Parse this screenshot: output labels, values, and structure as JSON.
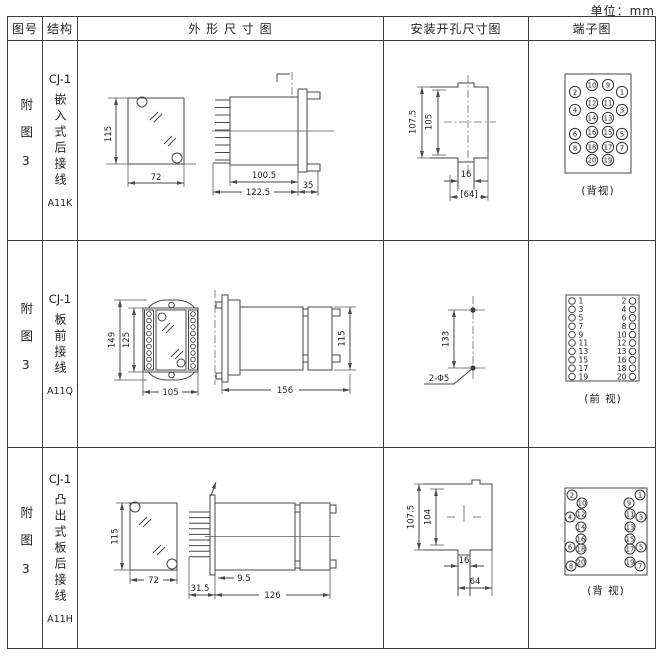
{
  "unit_label": "单位：mm",
  "header": {
    "fig_no": "图号",
    "structure": "结构",
    "outline": "外 形 尺 寸 图",
    "install": "安装开孔尺寸图",
    "terminal": "端子图"
  },
  "rows": [
    {
      "fig_no": "附图3",
      "model": "CJ-1",
      "mount_type": "嵌入式后接线",
      "code": "A11K",
      "outline": {
        "front_height": "115",
        "front_width": "72",
        "body_depth": "100.5",
        "total_depth": "122.5",
        "flange_depth": "35"
      },
      "install": {
        "height_outer": "107.5",
        "height_inner": "105",
        "notch_width": "16",
        "cutout_width": "[64]"
      },
      "terminal": {
        "caption": "(背视)",
        "inner_left": [
          "10",
          "12",
          "14",
          "16",
          "18",
          "20"
        ],
        "inner_right": [
          "9",
          "11",
          "13",
          "15",
          "17",
          "19"
        ],
        "outer_left": [
          "2",
          "4",
          "6",
          "8"
        ],
        "outer_right": [
          "1",
          "3",
          "5",
          "7"
        ]
      }
    },
    {
      "fig_no": "附图3",
      "model": "CJ-1",
      "mount_type": "板前接线",
      "code": "A11Q",
      "outline": {
        "front_height_outer": "149",
        "front_height_inner": "125",
        "front_width": "105",
        "total_depth": "156",
        "body_height": "115"
      },
      "install": {
        "hole_spacing": "133",
        "hole_note": "2-Φ5"
      },
      "terminal": {
        "caption": "(前 视)",
        "left": [
          "1",
          "3",
          "5",
          "7",
          "9",
          "11",
          "13",
          "15",
          "17",
          "19"
        ],
        "right": [
          "2",
          "4",
          "6",
          "8",
          "10",
          "12",
          "13",
          "16",
          "18",
          "20"
        ]
      }
    },
    {
      "fig_no": "附图3",
      "model": "CJ-1",
      "mount_type": "凸出式板后接线",
      "code": "A11H",
      "outline": {
        "front_height": "115",
        "front_width": "72",
        "pin_depth": "31.5",
        "gap": "9.5",
        "body_depth": "126"
      },
      "install": {
        "height_outer": "107.5",
        "height_inner": "104",
        "notch_width": "16",
        "cutout_width": "64"
      },
      "terminal": {
        "caption": "(背 视)",
        "left_top": "2",
        "left_outer": [
          "4",
          "6",
          "8"
        ],
        "left_inner": [
          "10",
          "12",
          "14",
          "16",
          "18",
          "20"
        ],
        "right_top": "1",
        "right_outer": [
          "3",
          "5",
          "7"
        ],
        "right_inner": [
          "9",
          "11",
          "13",
          "15",
          "17",
          "19"
        ]
      }
    }
  ]
}
